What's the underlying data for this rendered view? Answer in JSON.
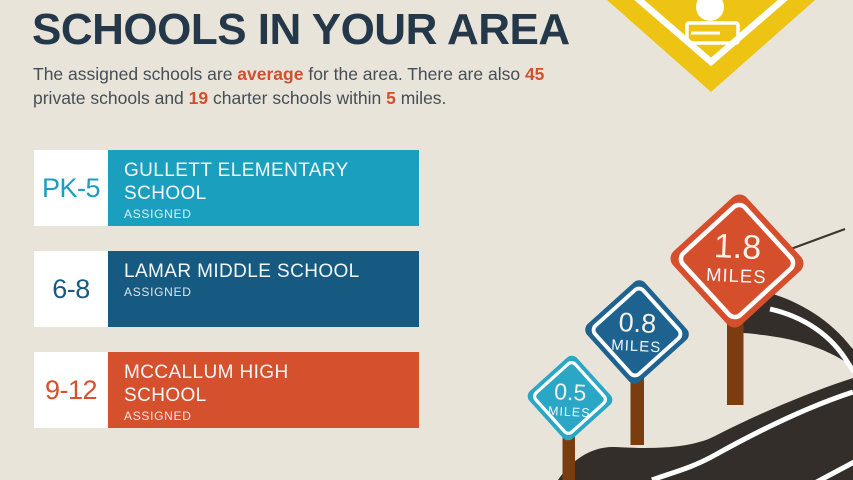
{
  "header": {
    "title": "SCHOOLS IN YOUR AREA",
    "subtitle_line1": [
      {
        "text": "The assigned schools are "
      },
      {
        "text": "average",
        "bold": true
      },
      {
        "text": " for the area. There are also "
      },
      {
        "text": "45",
        "bold": true
      }
    ],
    "subtitle_line2": [
      {
        "text": "private schools and "
      },
      {
        "text": "19",
        "bold": true
      },
      {
        "text": " charter schools within "
      },
      {
        "text": "5",
        "bold": true
      },
      {
        "text": " miles."
      }
    ]
  },
  "schools": [
    {
      "grades": "PK-5",
      "name": "GULLETT ELEMENTARY SCHOOL",
      "status": "ASSIGNED",
      "color": "#1B9FBE"
    },
    {
      "grades": "6-8",
      "name": "LAMAR MIDDLE SCHOOL",
      "status": "ASSIGNED",
      "color": "#175A81"
    },
    {
      "grades": "9-12",
      "name": "MCCALLUM HIGH SCHOOL",
      "status": "ASSIGNED",
      "color": "#D5502D"
    }
  ],
  "distance_signs": [
    {
      "value": "0.5",
      "unit": "MILES",
      "color": "#2BA7C6"
    },
    {
      "value": "0.8",
      "unit": "MILES",
      "color": "#1E6290"
    },
    {
      "value": "1.8",
      "unit": "MILES",
      "color": "#D64F2C"
    }
  ],
  "school_zone_sign": {
    "icon": "apple-on-book-icon",
    "color": "#EDC414"
  },
  "colors": {
    "background": "#E9E4DA",
    "title_text": "#25384A",
    "body_text": "#454D57",
    "accent": "#D0502E",
    "road": "#332E29",
    "road_line": "#FFFFFF",
    "sign_post": "#7B3C10",
    "card_level_bg": "#FFFFFF"
  }
}
